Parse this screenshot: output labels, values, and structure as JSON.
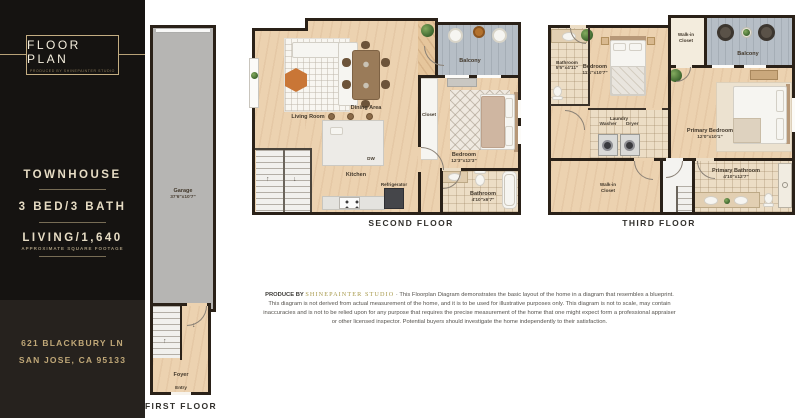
{
  "sidebar": {
    "logo_title": "FLOOR PLAN",
    "logo_subtitle": "PRODUCED BY SHINEPAINTER STUDIO",
    "property_type": "TOWNHOUSE",
    "beds_baths": "3 BED/3 BATH",
    "living_area": "LIVING/1,640",
    "living_area_note": "APPROXIMATE SQUARE FOOTAGE",
    "address_line1": "621 BLACKBURY LN",
    "address_line2": "SAN JOSE, CA 95133"
  },
  "floors": {
    "first": {
      "caption": "FIRST FLOOR",
      "garage": {
        "name": "Garage",
        "dims": "37'6\"x10'7\""
      },
      "foyer": {
        "name": "Foyer"
      },
      "entry": {
        "name": "Entry"
      }
    },
    "second": {
      "caption": "SECOND FLOOR",
      "living_room": {
        "name": "Living Room"
      },
      "dining_area": {
        "name": "Dining Area"
      },
      "balcony": {
        "name": "Balcony"
      },
      "closet": {
        "name": "Closet"
      },
      "kitchen": {
        "name": "Kitchen"
      },
      "dishwasher": {
        "name": "DW"
      },
      "refrigerator": {
        "name": "Refrigerator"
      },
      "bedroom": {
        "name": "Bedroom",
        "dims": "12'3\"x12'3\""
      },
      "bathroom": {
        "name": "Bathroom",
        "dims": "4'10\"x6'7\""
      }
    },
    "third": {
      "caption": "THIRD FLOOR",
      "bathroom": {
        "name": "Bathroom",
        "dims": "5'5\"x4'11\""
      },
      "bedroom": {
        "name": "Bedroom",
        "dims": "11'1\"x10'7\""
      },
      "walkin_closet_top": {
        "name": "Walk-in Closet"
      },
      "balcony": {
        "name": "Balcony"
      },
      "laundry": {
        "name": "Laundry",
        "appliances": "Washer Dryer"
      },
      "primary_bedroom": {
        "name": "Primary Bedroom",
        "dims": "12'0\"x10'1\""
      },
      "walkin_closet_bottom": {
        "name": "Walk-in Closet"
      },
      "primary_bathroom": {
        "name": "Primary Bathroom",
        "dims": "4'10\"x12'7\""
      }
    }
  },
  "disclaimer": {
    "produced_by": "PRODUCE BY",
    "studio": "SHINEPAINTER STUDIO",
    "text": "· This Floorplan Diagram demonstrates the basic layout of the home in a diagram that resembles a blueprint.  This diagram is not derived from actual measurement of the home, and it is to be used for illustrative purposes only.  This diagram is not to scale, may contain inaccuracies and is not to be relied upon for any purpose that requires the precise measurement of the home that one might expect form a professional appraiser or other licensed inspector.  Potential buyers should investigate the home independently to their satisfaction."
  },
  "colors": {
    "accent_gold": "#c9b185",
    "sidebar_black": "#151311",
    "floor_wood": "#ecd2b0",
    "wall": "#2a2118",
    "balcony_gray": "#b6bec6",
    "garage_gray": "#b6b5b3",
    "studio_gold": "#a89a4c"
  }
}
